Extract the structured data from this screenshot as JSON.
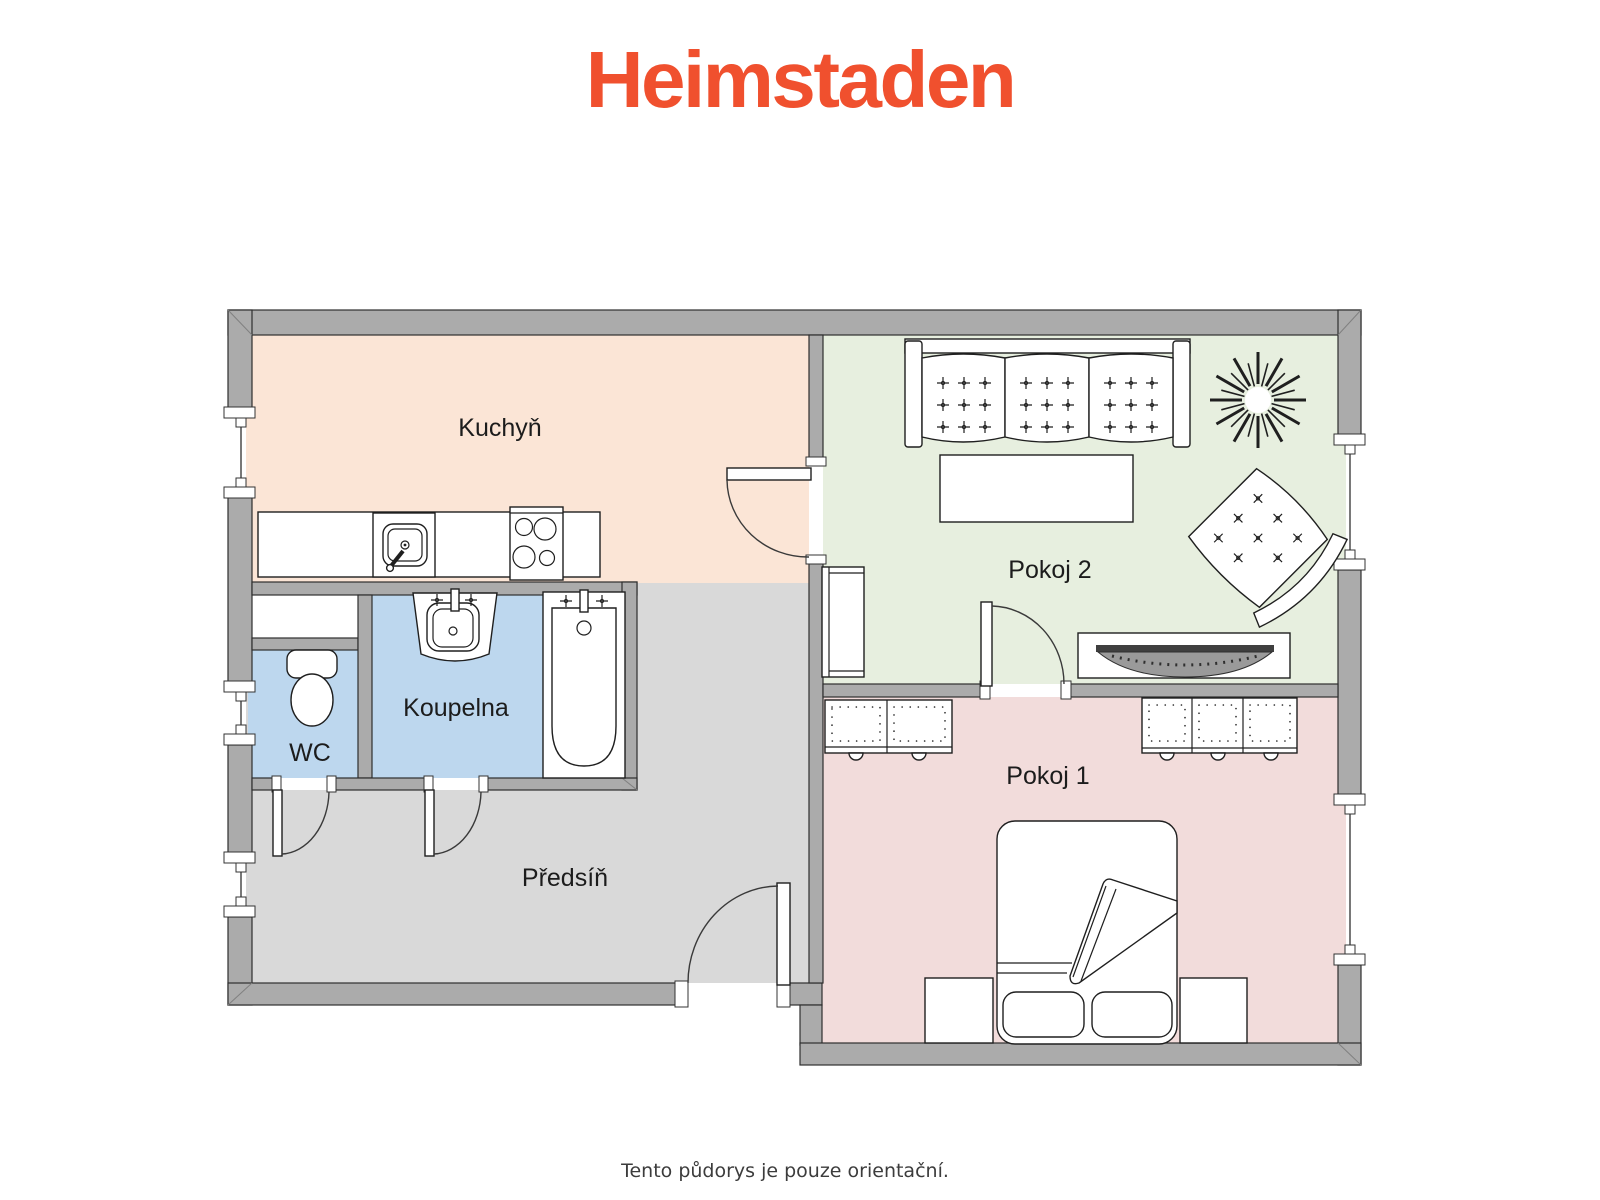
{
  "brand": {
    "logo_text": "Heimstaden",
    "logo_color": "#f0502e"
  },
  "footer": {
    "disclaimer": "Tento půdorys je pouze orientační."
  },
  "floorplan": {
    "wall_color": "#ababab",
    "outline_color": "#2e2e2e",
    "rooms": [
      {
        "id": "kuchyn",
        "label": "Kuchyň",
        "color": "#fbe5d6",
        "furniture": [
          "kitchen-counter",
          "kitchen-sink",
          "stove"
        ]
      },
      {
        "id": "pokoj2",
        "label": "Pokoj 2",
        "color": "#e7efdf",
        "furniture": [
          "sofa",
          "coffee-table",
          "tv-stand",
          "tv",
          "armchair",
          "plant",
          "shelf-unit"
        ]
      },
      {
        "id": "koupelna",
        "label": "Koupelna",
        "color": "#bdd7ee",
        "furniture": [
          "washbasin",
          "bathtub"
        ]
      },
      {
        "id": "wc",
        "label": "WC",
        "color": "#bdd7ee",
        "furniture": [
          "toilet"
        ]
      },
      {
        "id": "predsin",
        "label": "Předsíň",
        "color": "#d9d9d9",
        "furniture": []
      },
      {
        "id": "pokoj1",
        "label": "Pokoj 1",
        "color": "#f2dcdb",
        "furniture": [
          "bed",
          "nightstand",
          "nightstand",
          "wardrobe-2-door",
          "wardrobe-3-door"
        ]
      }
    ]
  }
}
